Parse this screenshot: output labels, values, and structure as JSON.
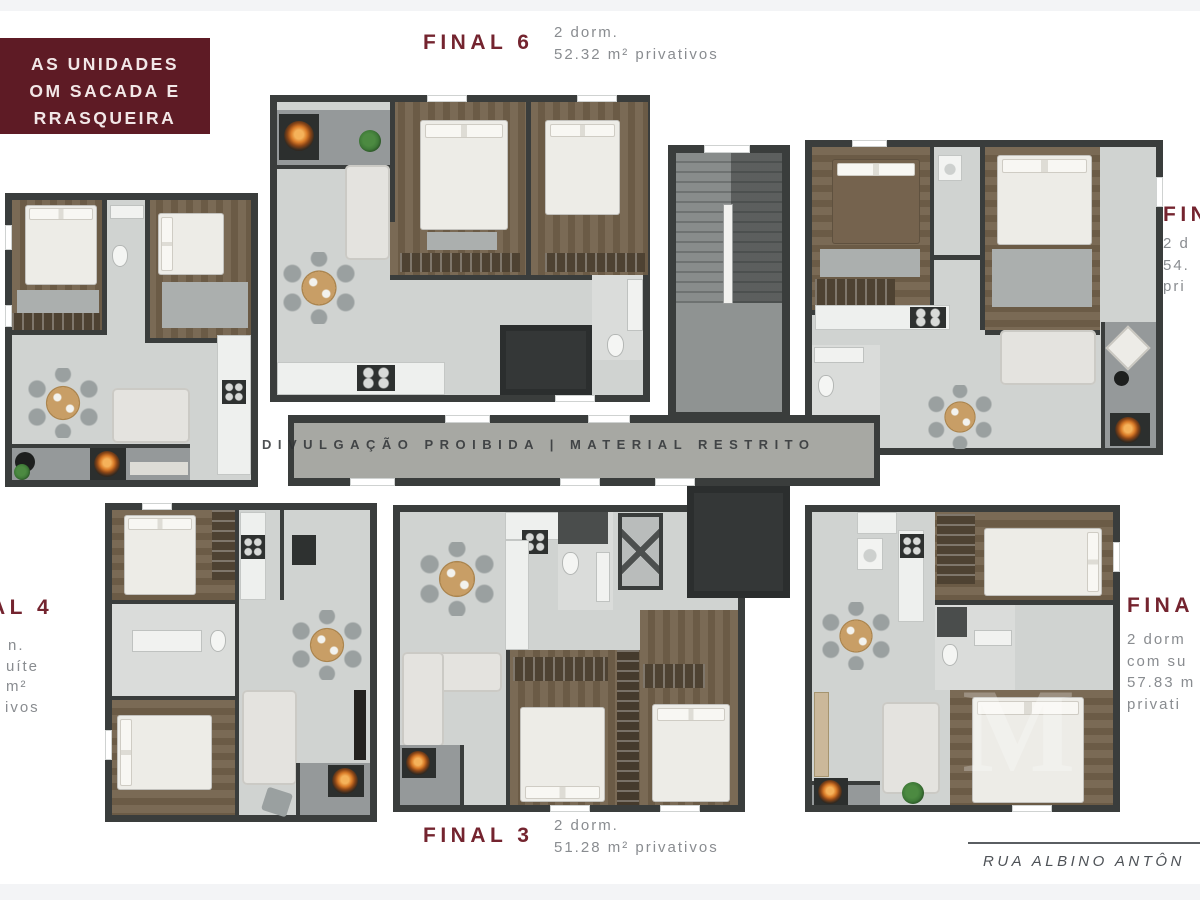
{
  "palette": {
    "background": "#ffffff",
    "edge_band": "#f3f4f6",
    "wall": "#3a3d3c",
    "floor": "#d0d3d1",
    "floor_light": "#dadcda",
    "balcony_floor": "#95999a",
    "corridor_floor": "#a7a8a3",
    "wood": "#7a6a55",
    "wood_dark": "#6b5b46",
    "wardrobe": "#4e4232",
    "bed_white": "#edece7",
    "bed_brown": "#75634e",
    "rug": "#abafae",
    "sofa": "#e4e3df",
    "counter": "#eef0ee",
    "appliance_dark": "#2e3130",
    "table_wood": "#c89e66",
    "chair_gray": "#9aa0a0",
    "grill_orange": "#d97b28",
    "plant_green": "#3f7a38",
    "shaft": "#343737",
    "maroon_box": "#5e1b25",
    "maroon_box_text": "#f2e7e7",
    "maroon_title": "#74242f",
    "gray_text": "#898c90",
    "watermark_text": "#303336",
    "street_text": "#4e5257"
  },
  "badge": {
    "line1": "AS UNIDADES",
    "line2": "OM SACADA E",
    "line3": "RRASQUEIRA"
  },
  "labels": {
    "final6": {
      "title": "FINAL 6",
      "line1": "2 dorm.",
      "line2": "52.32 m² privativos"
    },
    "final3": {
      "title": "FINAL 3",
      "line1": "2 dorm.",
      "line2": "51.28 m² privativos"
    },
    "right_top": {
      "title": "FIN",
      "line1": "2 d",
      "line2": "54.",
      "line3": "pri"
    },
    "right_bottom": {
      "title": "FINA",
      "line1": "2 dorm",
      "line2": "com su",
      "line3": "57.83 m",
      "line4": "privati"
    },
    "left_mid": {
      "title": "AL 4",
      "line1": "n.",
      "line2": "uíte",
      "line3": "m²",
      "line4": "ivos"
    }
  },
  "watermark_text": "DIVULGAÇÃO PROIBIDA | MATERIAL RESTRITO",
  "photo_watermark": "M",
  "footer": {
    "street": "RUA ALBINO ANTÔN"
  }
}
